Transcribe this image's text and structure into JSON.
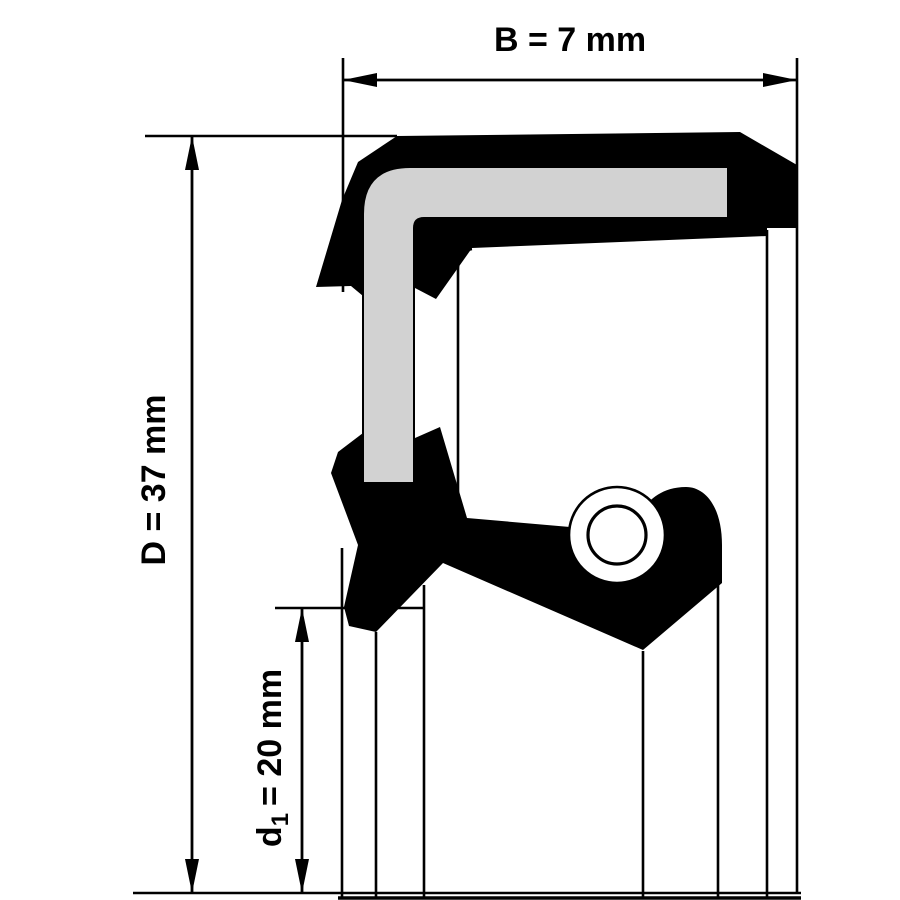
{
  "diagram": {
    "subject": "radial shaft seal cross-section",
    "dimensions": {
      "b": {
        "label": "B = 7 mm",
        "name": "B",
        "value": 7,
        "unit": "mm"
      },
      "d": {
        "label": "D = 37 mm",
        "name": "D",
        "value": 37,
        "unit": "mm"
      },
      "d1": {
        "sym": "d",
        "sub": "1",
        "rest": "= 20 mm",
        "name": "d1",
        "value": 20,
        "unit": "mm"
      }
    }
  },
  "colors": {
    "ink": "#000000",
    "insert_gray": "#d2d2d2",
    "background": "#ffffff"
  }
}
